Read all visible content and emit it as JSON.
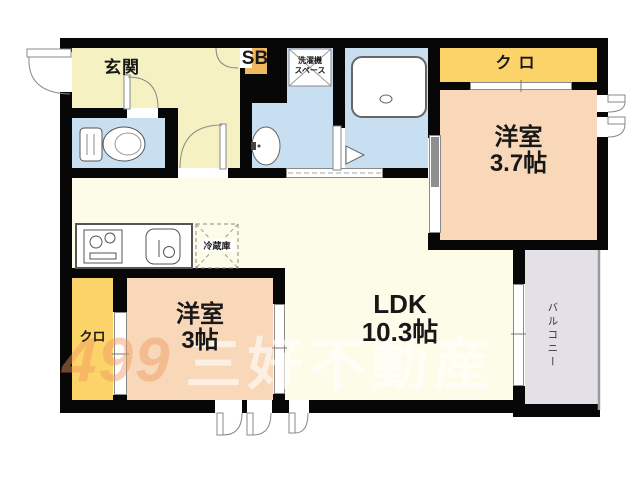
{
  "labels": {
    "genkan": "玄関",
    "sb": "SB",
    "laundry_line1": "洗濯機",
    "laundry_line2": "スペース",
    "closet_top": "クロ",
    "bedroom37_name": "洋室",
    "bedroom37_size": "3.7帖",
    "fridge": "冷蔵庫",
    "ldk_name": "LDK",
    "ldk_size": "10.3帖",
    "bedroom3_name": "洋室",
    "bedroom3_size": "3帖",
    "closet_left": "クロ",
    "balcony": "バルコニー"
  },
  "watermark": {
    "logo": "499",
    "company": "三好不動産"
  },
  "colors": {
    "wall": "#070707",
    "hall_yellow": "#f5f1c3",
    "ldk_cream": "#fdfce8",
    "wet_blue": "#c8dff2",
    "bedroom_peach": "#f8d8b9",
    "closet_yellow": "#fbd368",
    "shoebox_orange": "#f0b95f",
    "balcony_gray": "#e3e1e7"
  }
}
